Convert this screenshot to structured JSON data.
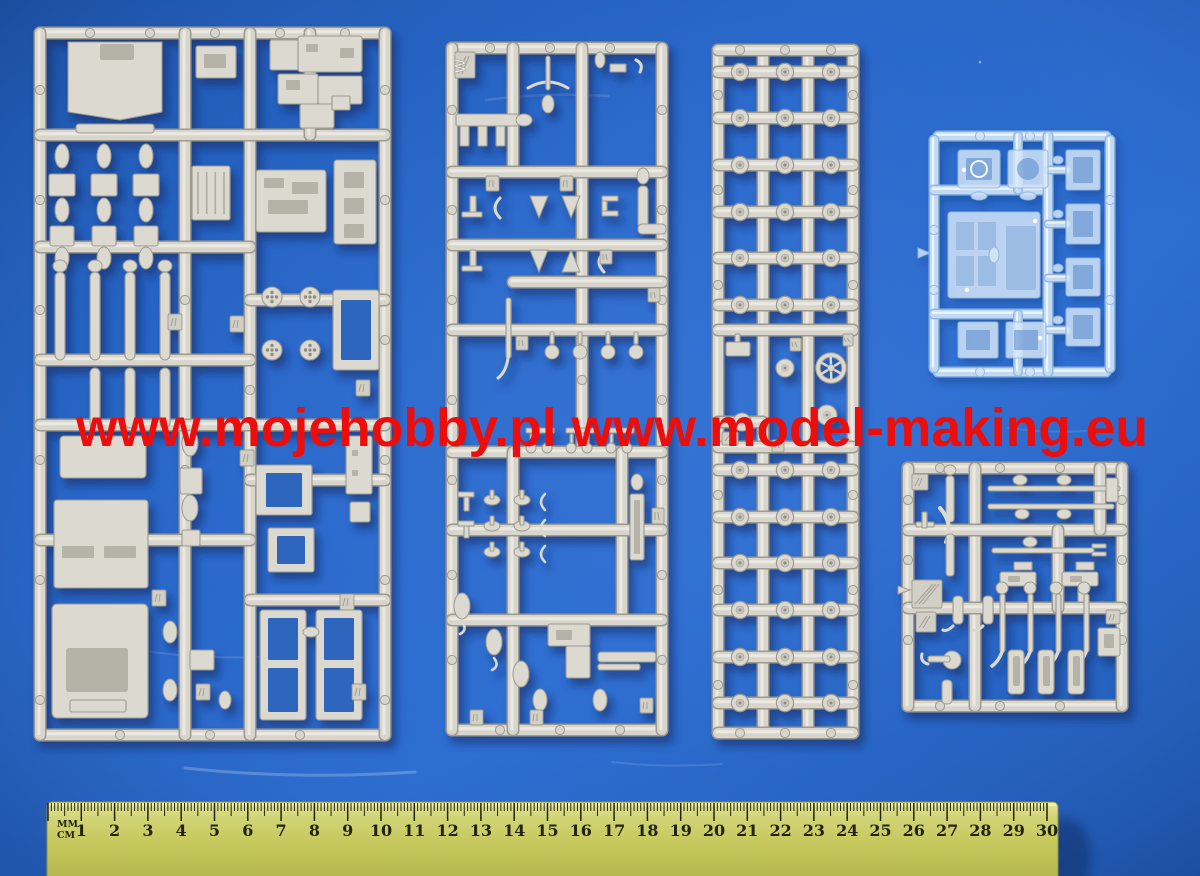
{
  "photo": {
    "subject": "five injection-molded model kit sprues on blue background with ruler",
    "background_blue": "#2263c4",
    "background_blue_dark": "#1c52a8",
    "background_blue_light": "#2f6fd2",
    "sprue_grey": "#d7d5cc",
    "sprue_grey_edge": "#9d9a8f",
    "sprue_grey_highlight": "#efede6",
    "clear_sprue_tint": "#cfe2f6"
  },
  "watermark": {
    "text": "www.mojehobby.pl www.model-making.eu",
    "color": "#ec0d0d"
  },
  "sprues": [
    {
      "id": "sprue-large-left",
      "material": "grey styrene"
    },
    {
      "id": "sprue-middle",
      "material": "grey styrene",
      "molded_letter": "W"
    },
    {
      "id": "sprue-wheels",
      "material": "grey styrene"
    },
    {
      "id": "sprue-clear-glazing",
      "material": "transparent styrene"
    },
    {
      "id": "sprue-axles-bottom-right",
      "material": "grey styrene"
    }
  ],
  "ruler": {
    "unit_top": "MM",
    "unit_bottom": "CM",
    "numbers": [
      "1",
      "2",
      "3",
      "4",
      "5",
      "6",
      "7",
      "8",
      "9",
      "10",
      "11",
      "12",
      "13",
      "14",
      "15",
      "16",
      "17",
      "18",
      "19",
      "20",
      "21",
      "22",
      "23",
      "24",
      "25",
      "26",
      "27",
      "28",
      "29",
      "30"
    ],
    "body_color": "#c6c95d",
    "tick_color": "#23230f"
  }
}
